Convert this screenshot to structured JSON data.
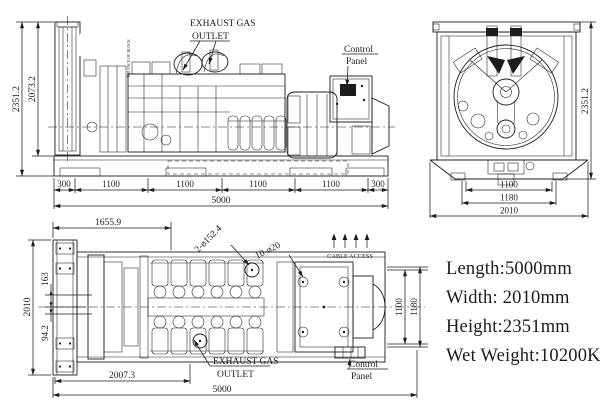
{
  "drawing": {
    "colors": {
      "line": "#1c1c1c",
      "background": "#ffffff"
    },
    "side_view": {
      "exhaust_label1": "EXHAUST GAS",
      "exhaust_label2": "OUTLET",
      "control_label1": "Control",
      "control_label2": "Panel",
      "block_note": "TOP FACE OF BLOCK",
      "dim_height_overall": "2351.2",
      "dim_height_to_skid": "2073.2",
      "seg": [
        "300",
        "1100",
        "1100",
        "1100",
        "1100",
        "300"
      ],
      "dim_total": "5000"
    },
    "end_view": {
      "dim_height": "2351.2",
      "dim_inner": "1100",
      "dim_middle": "1180",
      "dim_width": "2010"
    },
    "plan_view": {
      "dim_top": "1655.9",
      "holes_label1": "2-ø152.4",
      "holes_label2": "10-ø20",
      "cable_access": "CABLE ACCESS",
      "dim_width": "2010",
      "dim_offset1": "163",
      "dim_offset2": "94.2",
      "dim_right_inner": "1100",
      "dim_right_outer": "1180",
      "exhaust_label1": "EXHAUST GAS",
      "exhaust_label2": "OUTLET",
      "control_label1": "Control",
      "control_label2": "Panel",
      "dim_bottom_part": "2007.3",
      "dim_bottom_total": "5000"
    },
    "specs": {
      "length": "Length:5000mm",
      "width": "Width: 2010mm",
      "height": "Height:2351mm",
      "weight": "Wet Weight:10200Kg"
    }
  }
}
